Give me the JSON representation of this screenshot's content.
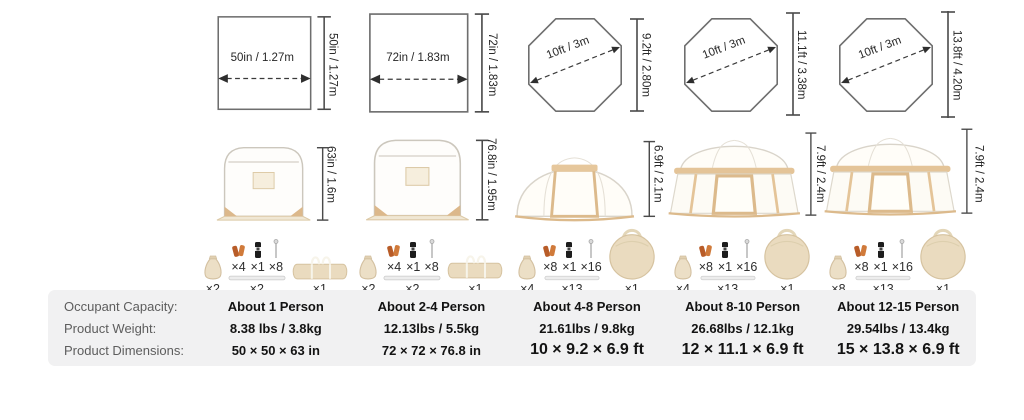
{
  "table": {
    "row_labels": {
      "capacity": "Occupant Capacity:",
      "weight": "Product Weight:",
      "dimensions": "Product Dimensions:"
    }
  },
  "products": [
    {
      "footprint": {
        "shape": "square",
        "width_label": "50in / 1.27m",
        "height_label": "50in / 1.27m"
      },
      "tent": {
        "style": "pop-up-cube",
        "height_label": "63in / 1.6m"
      },
      "accessories": {
        "sandbag": "×2",
        "stakes": "×4",
        "connector": "×1",
        "nails": "×8",
        "poles": "×2",
        "bag": "×1"
      },
      "capacity": "About 1 Person",
      "weight": "8.38 lbs / 3.8kg",
      "dimensions": "50 × 50 × 63 in"
    },
    {
      "footprint": {
        "shape": "square",
        "width_label": "72in / 1.83m",
        "height_label": "72in / 1.83m"
      },
      "tent": {
        "style": "pop-up-cube",
        "height_label": "76.8in / 1.95m"
      },
      "accessories": {
        "sandbag": "×2",
        "stakes": "×4",
        "connector": "×1",
        "nails": "×8",
        "poles": "×2",
        "bag": "×1"
      },
      "capacity": "About 2-4 Person",
      "weight": "12.13lbs / 5.5kg",
      "dimensions": "72 × 72 × 76.8 in"
    },
    {
      "footprint": {
        "shape": "octagon",
        "width_label": "10ft / 3m",
        "height_label": "9.2ft / 2.80m"
      },
      "tent": {
        "style": "dome",
        "height_label": "6.9ft / 2.1m"
      },
      "accessories": {
        "sandbag": "×4",
        "stakes": "×8",
        "connector": "×1",
        "nails": "×16",
        "poles": "×13",
        "bag": "×1"
      },
      "capacity": "About 4-8 Person",
      "weight": "21.61lbs / 9.8kg",
      "dimensions": "10 × 9.2 × 6.9 ft"
    },
    {
      "footprint": {
        "shape": "octagon",
        "width_label": "10ft / 3m",
        "height_label": "11.1ft / 3.38m"
      },
      "tent": {
        "style": "pavilion",
        "height_label": "7.9ft / 2.4m"
      },
      "accessories": {
        "sandbag": "×4",
        "stakes": "×8",
        "connector": "×1",
        "nails": "×16",
        "poles": "×13",
        "bag": "×1"
      },
      "capacity": "About 8-10 Person",
      "weight": "26.68lbs / 12.1kg",
      "dimensions": "12 × 11.1 × 6.9 ft"
    },
    {
      "footprint": {
        "shape": "octagon",
        "width_label": "10ft / 3m",
        "height_label": "13.8ft / 4.20m"
      },
      "tent": {
        "style": "pavilion",
        "height_label": "7.9ft / 2.4m"
      },
      "accessories": {
        "sandbag": "×8",
        "stakes": "×8",
        "connector": "×1",
        "nails": "×16",
        "poles": "×13",
        "bag": "×1"
      },
      "capacity": "About 12-15 Person",
      "weight": "29.54lbs / 13.4kg",
      "dimensions": "15 × 13.8 × 6.9 ft"
    }
  ]
}
